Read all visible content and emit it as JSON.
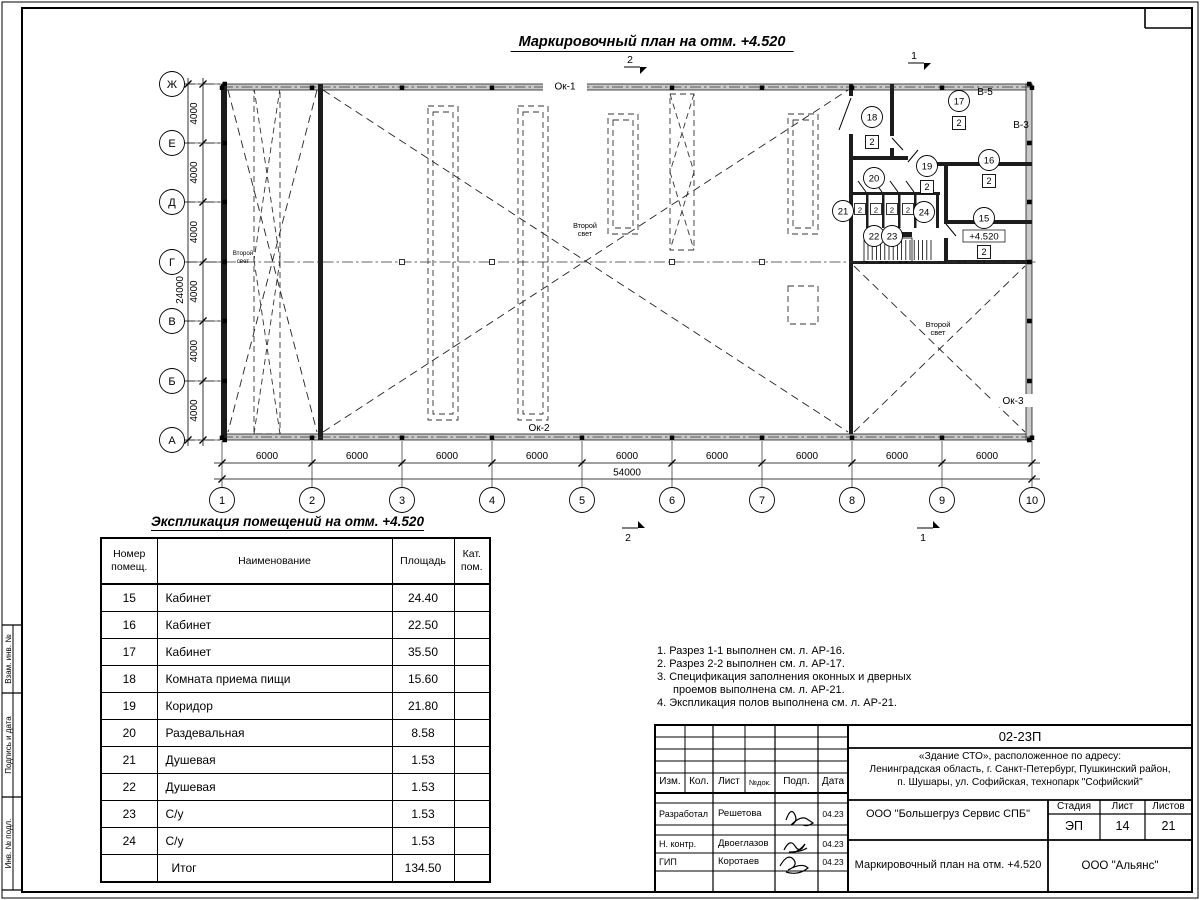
{
  "plan": {
    "title": "Маркировочный план на отм. +4.520",
    "row_axes": [
      "Ж",
      "Е",
      "Д",
      "Г",
      "В",
      "Б",
      "А"
    ],
    "col_axes": [
      "1",
      "2",
      "3",
      "4",
      "5",
      "6",
      "7",
      "8",
      "9",
      "10"
    ],
    "row_dims": [
      "4000",
      "4000",
      "4000",
      "4000",
      "4000",
      "4000"
    ],
    "row_total": "24000",
    "col_dims": [
      "6000",
      "6000",
      "6000",
      "6000",
      "6000",
      "6000",
      "6000",
      "6000",
      "6000"
    ],
    "col_total": "54000",
    "windows": [
      "Ок-1",
      "Ок-2",
      "Ок-3"
    ],
    "vents": [
      "В-5",
      "В-3"
    ],
    "second_light": [
      "Второй",
      "свет"
    ],
    "level_mark": "+4.520",
    "section_marks": {
      "top": [
        "2",
        "1"
      ],
      "bottom": [
        "2",
        "1"
      ]
    },
    "rooms": [
      {
        "num": "15",
        "cat": "2"
      },
      {
        "num": "16",
        "cat": "2"
      },
      {
        "num": "17",
        "cat": "2"
      },
      {
        "num": "18",
        "cat": "2"
      },
      {
        "num": "19",
        "cat": "2"
      },
      {
        "num": "20"
      },
      {
        "num": "21"
      },
      {
        "num": "22"
      },
      {
        "num": "23"
      },
      {
        "num": "24"
      }
    ],
    "stall_categories": [
      "2",
      "2",
      "2",
      "2"
    ]
  },
  "schedule": {
    "title": "Экспликация помещений на отм. +4.520",
    "headers": [
      [
        "Номер",
        "помещ."
      ],
      [
        "Наименование"
      ],
      [
        "Площадь"
      ],
      [
        "Кат.",
        "пом."
      ]
    ],
    "rows": [
      [
        "15",
        "Кабинет",
        "24.40",
        ""
      ],
      [
        "16",
        "Кабинет",
        "22.50",
        ""
      ],
      [
        "17",
        "Кабинет",
        "35.50",
        ""
      ],
      [
        "18",
        "Комната приема пищи",
        "15.60",
        ""
      ],
      [
        "19",
        "Коридор",
        "21.80",
        ""
      ],
      [
        "20",
        "Раздевальная",
        "8.58",
        ""
      ],
      [
        "21",
        "Душевая",
        "1.53",
        ""
      ],
      [
        "22",
        "Душевая",
        "1.53",
        ""
      ],
      [
        "23",
        "С/у",
        "1.53",
        ""
      ],
      [
        "24",
        "С/у",
        "1.53",
        ""
      ],
      [
        "",
        "Итог",
        "134.50",
        ""
      ]
    ]
  },
  "notes": [
    "1. Разрез 1-1 выполнен см. л. АР-16.",
    "2. Разрез 2-2 выполнен см. л. АР-17.",
    "3. Спецификация заполнения оконных и дверных проемов выполнена см. л. АР-21.",
    "4. Экспликация полов выполнена см. л. АР-21."
  ],
  "title_block": {
    "doc_number": "02-23П",
    "project_lines": [
      "«Здание СТО», расположенное по адресу:",
      "Ленинградская область, г. Санкт-Петербург, Пушкинский район,",
      "п. Шушары, ул. Софийская, технопарк \"Софийский\""
    ],
    "header_cols": [
      "Изм.",
      "Кол.",
      "Лист",
      "№док.",
      "Подп.",
      "Дата"
    ],
    "roles": [
      {
        "role": "Разработал",
        "name": "Решетова",
        "date": "04.23"
      },
      {
        "role": "Н. контр.",
        "name": "Двоеглазов",
        "date": "04.23"
      },
      {
        "role": "ГИП",
        "name": "Коротаев",
        "date": "04.23"
      }
    ],
    "company": "ООО \"Большегруз Сервис СПБ\"",
    "stage": {
      "labels": [
        "Стадия",
        "Лист",
        "Листов"
      ],
      "values": [
        "ЭП",
        "14",
        "21"
      ]
    },
    "drawing_name": "Маркировочный план на отм. +4.520",
    "org": "ООО \"Альянс\""
  },
  "frame": {
    "side_labels": [
      "Взам. инв. №",
      "Подпись и дата",
      "Инв. № подл."
    ]
  }
}
